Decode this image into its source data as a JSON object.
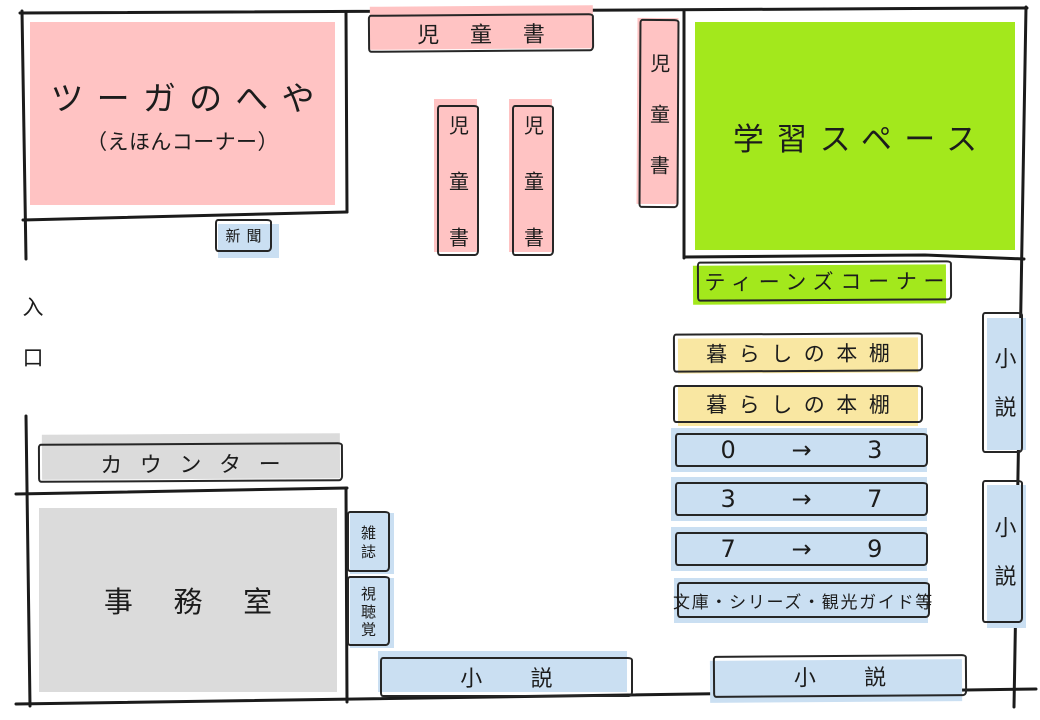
{
  "palette": {
    "pink": "#ffc3c3",
    "green": "#a3e81c",
    "blue": "#cadff2",
    "yellow": "#f9e7a2",
    "gray": "#dbdbdb",
    "wall": "#1b1b1b"
  },
  "entrance": {
    "label": "入口"
  },
  "rooms": {
    "tsuga": {
      "label": "ツーガのへや",
      "sublabel": "（えほんコーナー）"
    },
    "study": {
      "label": "学習スペース"
    },
    "office": {
      "label": "事務室"
    }
  },
  "shelves": {
    "children_top": {
      "label": "児童書"
    },
    "children_mid1": {
      "label": "児童書"
    },
    "children_mid2": {
      "label": "児童書"
    },
    "children_right": {
      "label": "児童書"
    },
    "newspaper": {
      "label": "新聞"
    },
    "teens_corner": {
      "label": "ティーンズコーナー"
    },
    "living_shelf_1": {
      "label": "暮らしの本棚"
    },
    "living_shelf_2": {
      "label": "暮らしの本棚"
    },
    "age_0_3": {
      "label": "0 → 3"
    },
    "age_3_7": {
      "label": "3 → 7"
    },
    "age_7_9": {
      "label": "7 → 9"
    },
    "paperback": {
      "label": "文庫・シリーズ・観光ガイド等"
    },
    "counter": {
      "label": "カウンター"
    },
    "magazines": {
      "label": "雑誌"
    },
    "audiovisual": {
      "label": "視聴覚"
    },
    "novel_side_upper": {
      "label": "小説"
    },
    "novel_side_lower": {
      "label": "小説"
    },
    "novel_bottom_left": {
      "label": "小説"
    },
    "novel_bottom_right": {
      "label": "小説"
    }
  }
}
